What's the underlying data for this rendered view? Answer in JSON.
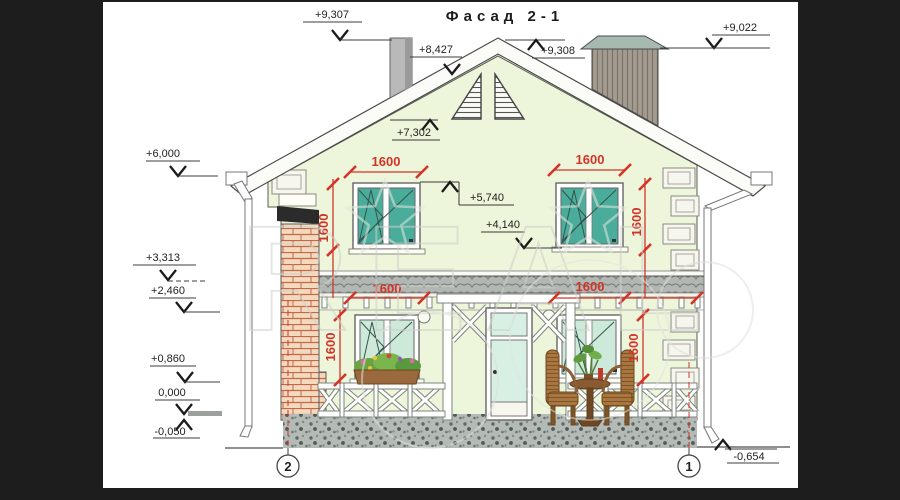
{
  "title": "Фасад 2-1",
  "axes": {
    "left": "2",
    "right": "1"
  },
  "elevations": {
    "m9307": "+9,307",
    "m8427": "+8,427",
    "m9308": "+9,308",
    "m9022": "+9,022",
    "m7302": "+7,302",
    "m6000": "+6,000",
    "m5740": "+5,740",
    "m4140": "+4,140",
    "m3313": "+3,313",
    "m2460": "+2,460",
    "m0860": "+0,860",
    "m0000": "0,000",
    "m0050": "-0,050",
    "m0654": "-0,654"
  },
  "dimensions": {
    "window_width": "1600",
    "window_height": "1600"
  },
  "watermark": {
    "text": "REAL"
  },
  "colors": {
    "dim_red": "#d23429",
    "wall_green": "#edf5da",
    "glass_upper": "#4aac9b",
    "glass_lower": "#cde9da",
    "brick": "#f3dabe",
    "mortar": "#c4684a"
  }
}
